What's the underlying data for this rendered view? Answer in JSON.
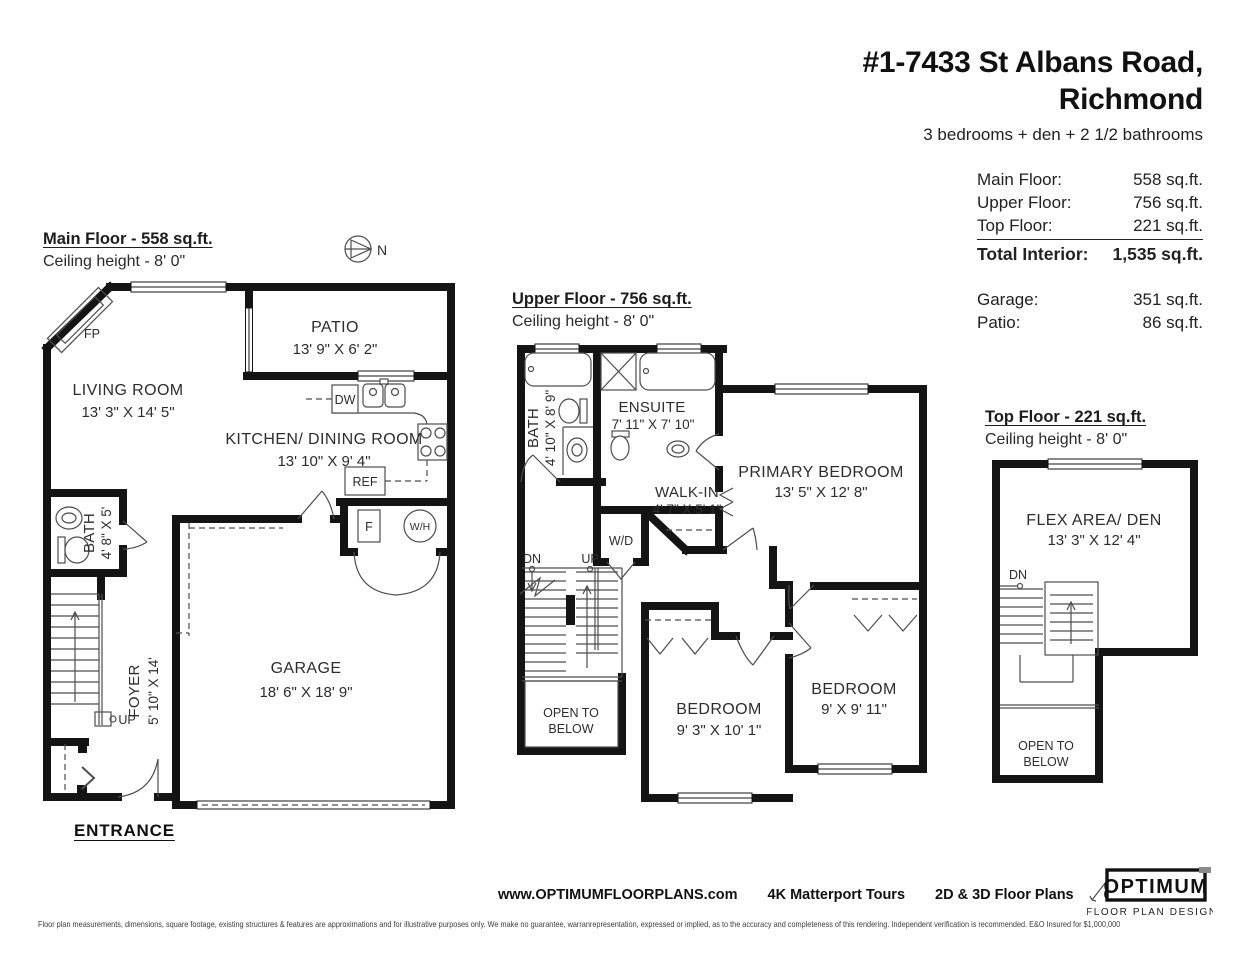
{
  "header": {
    "address_line1": "#1-7433 St Albans Road,",
    "address_line2": "Richmond",
    "subtitle": "3 bedrooms + den + 2 1/2 bathrooms"
  },
  "area_summary": {
    "rows": [
      {
        "label": "Main Floor:",
        "value": "558 sq.ft."
      },
      {
        "label": "Upper Floor:",
        "value": "756 sq.ft."
      },
      {
        "label": "Top Floor:",
        "value": "221 sq.ft."
      },
      {
        "label": "Total Interior:",
        "value": "1,535 sq.ft."
      }
    ],
    "outdoor_rows": [
      {
        "label": "Garage:",
        "value": "351 sq.ft."
      },
      {
        "label": "Patio:",
        "value": "86 sq.ft."
      }
    ]
  },
  "floors": {
    "main": {
      "title": "Main Floor - 558 sq.ft.",
      "ceiling": "Ceiling height - 8' 0\"",
      "entrance": "ENTRANCE",
      "compass": "N",
      "rooms": {
        "living": {
          "name": "LIVING ROOM",
          "dims": "13' 3\" X 14' 5\""
        },
        "patio": {
          "name": "PATIO",
          "dims": "13' 9\" X 6' 2\""
        },
        "kitchen": {
          "name": "KITCHEN/ DINING ROOM",
          "dims": "13' 10\" X 9' 4\""
        },
        "bath": {
          "name": "BATH",
          "dims": "4' 8\" X 5'"
        },
        "garage": {
          "name": "GARAGE",
          "dims": "18' 6\" X 18' 9\""
        },
        "foyer": {
          "name": "FOYER",
          "dims": "5' 10\" X 14'"
        }
      },
      "labels": {
        "fireplace": "FP",
        "dishwasher": "DW",
        "fridge": "REF",
        "furnace": "F",
        "water_heater": "W/H",
        "up": "UP"
      }
    },
    "upper": {
      "title": "Upper Floor - 756 sq.ft.",
      "ceiling": "Ceiling height - 8' 0\"",
      "rooms": {
        "bath": {
          "name": "BATH",
          "dims": "4' 10\" X 8' 9\""
        },
        "ensuite": {
          "name": "ENSUITE",
          "dims": "7' 11\" X 7' 10\""
        },
        "walk_in": {
          "name": "WALK-IN",
          "dims": "4' 7\" X 5' 1\""
        },
        "primary": {
          "name": "PRIMARY BEDROOM",
          "dims": "13' 5\" X 12' 8\""
        },
        "bedroom_mid": {
          "name": "BEDROOM",
          "dims": "9' 3\" X 10' 1\""
        },
        "bedroom_right": {
          "name": "BEDROOM",
          "dims": "9' X 9' 11\""
        }
      },
      "labels": {
        "washer_dryer": "W/D",
        "dn": "DN",
        "up": "UP",
        "open_line1": "OPEN TO",
        "open_line2": "BELOW"
      }
    },
    "top": {
      "title": "Top Floor - 221 sq.ft.",
      "ceiling": "Ceiling height - 8' 0\"",
      "rooms": {
        "flex": {
          "name": "FLEX AREA/ DEN",
          "dims": "13' 3\" X 12' 4\""
        }
      },
      "labels": {
        "dn": "DN",
        "open_line1": "OPEN TO",
        "open_line2": "BELOW"
      }
    }
  },
  "footer": {
    "website": "www.OPTIMUMFLOORPLANS.com",
    "service_tours": "4K Matterport Tours",
    "service_plans": "2D & 3D Floor Plans",
    "phone": "604-729-5033",
    "logo": {
      "name": "OPTIMUM",
      "tagline": "FLOOR PLAN DESIGNS"
    },
    "disclaimer": "Floor plan measurements, dimensions, square footage, existing structures & features are approximations and for illustrative purposes only. We make no guarantee, warranrepresentation, expressed or implied, as to the accuracy and completeness of this rendering. Independent verification is recommended. E&O Insured for $1,000,000"
  }
}
